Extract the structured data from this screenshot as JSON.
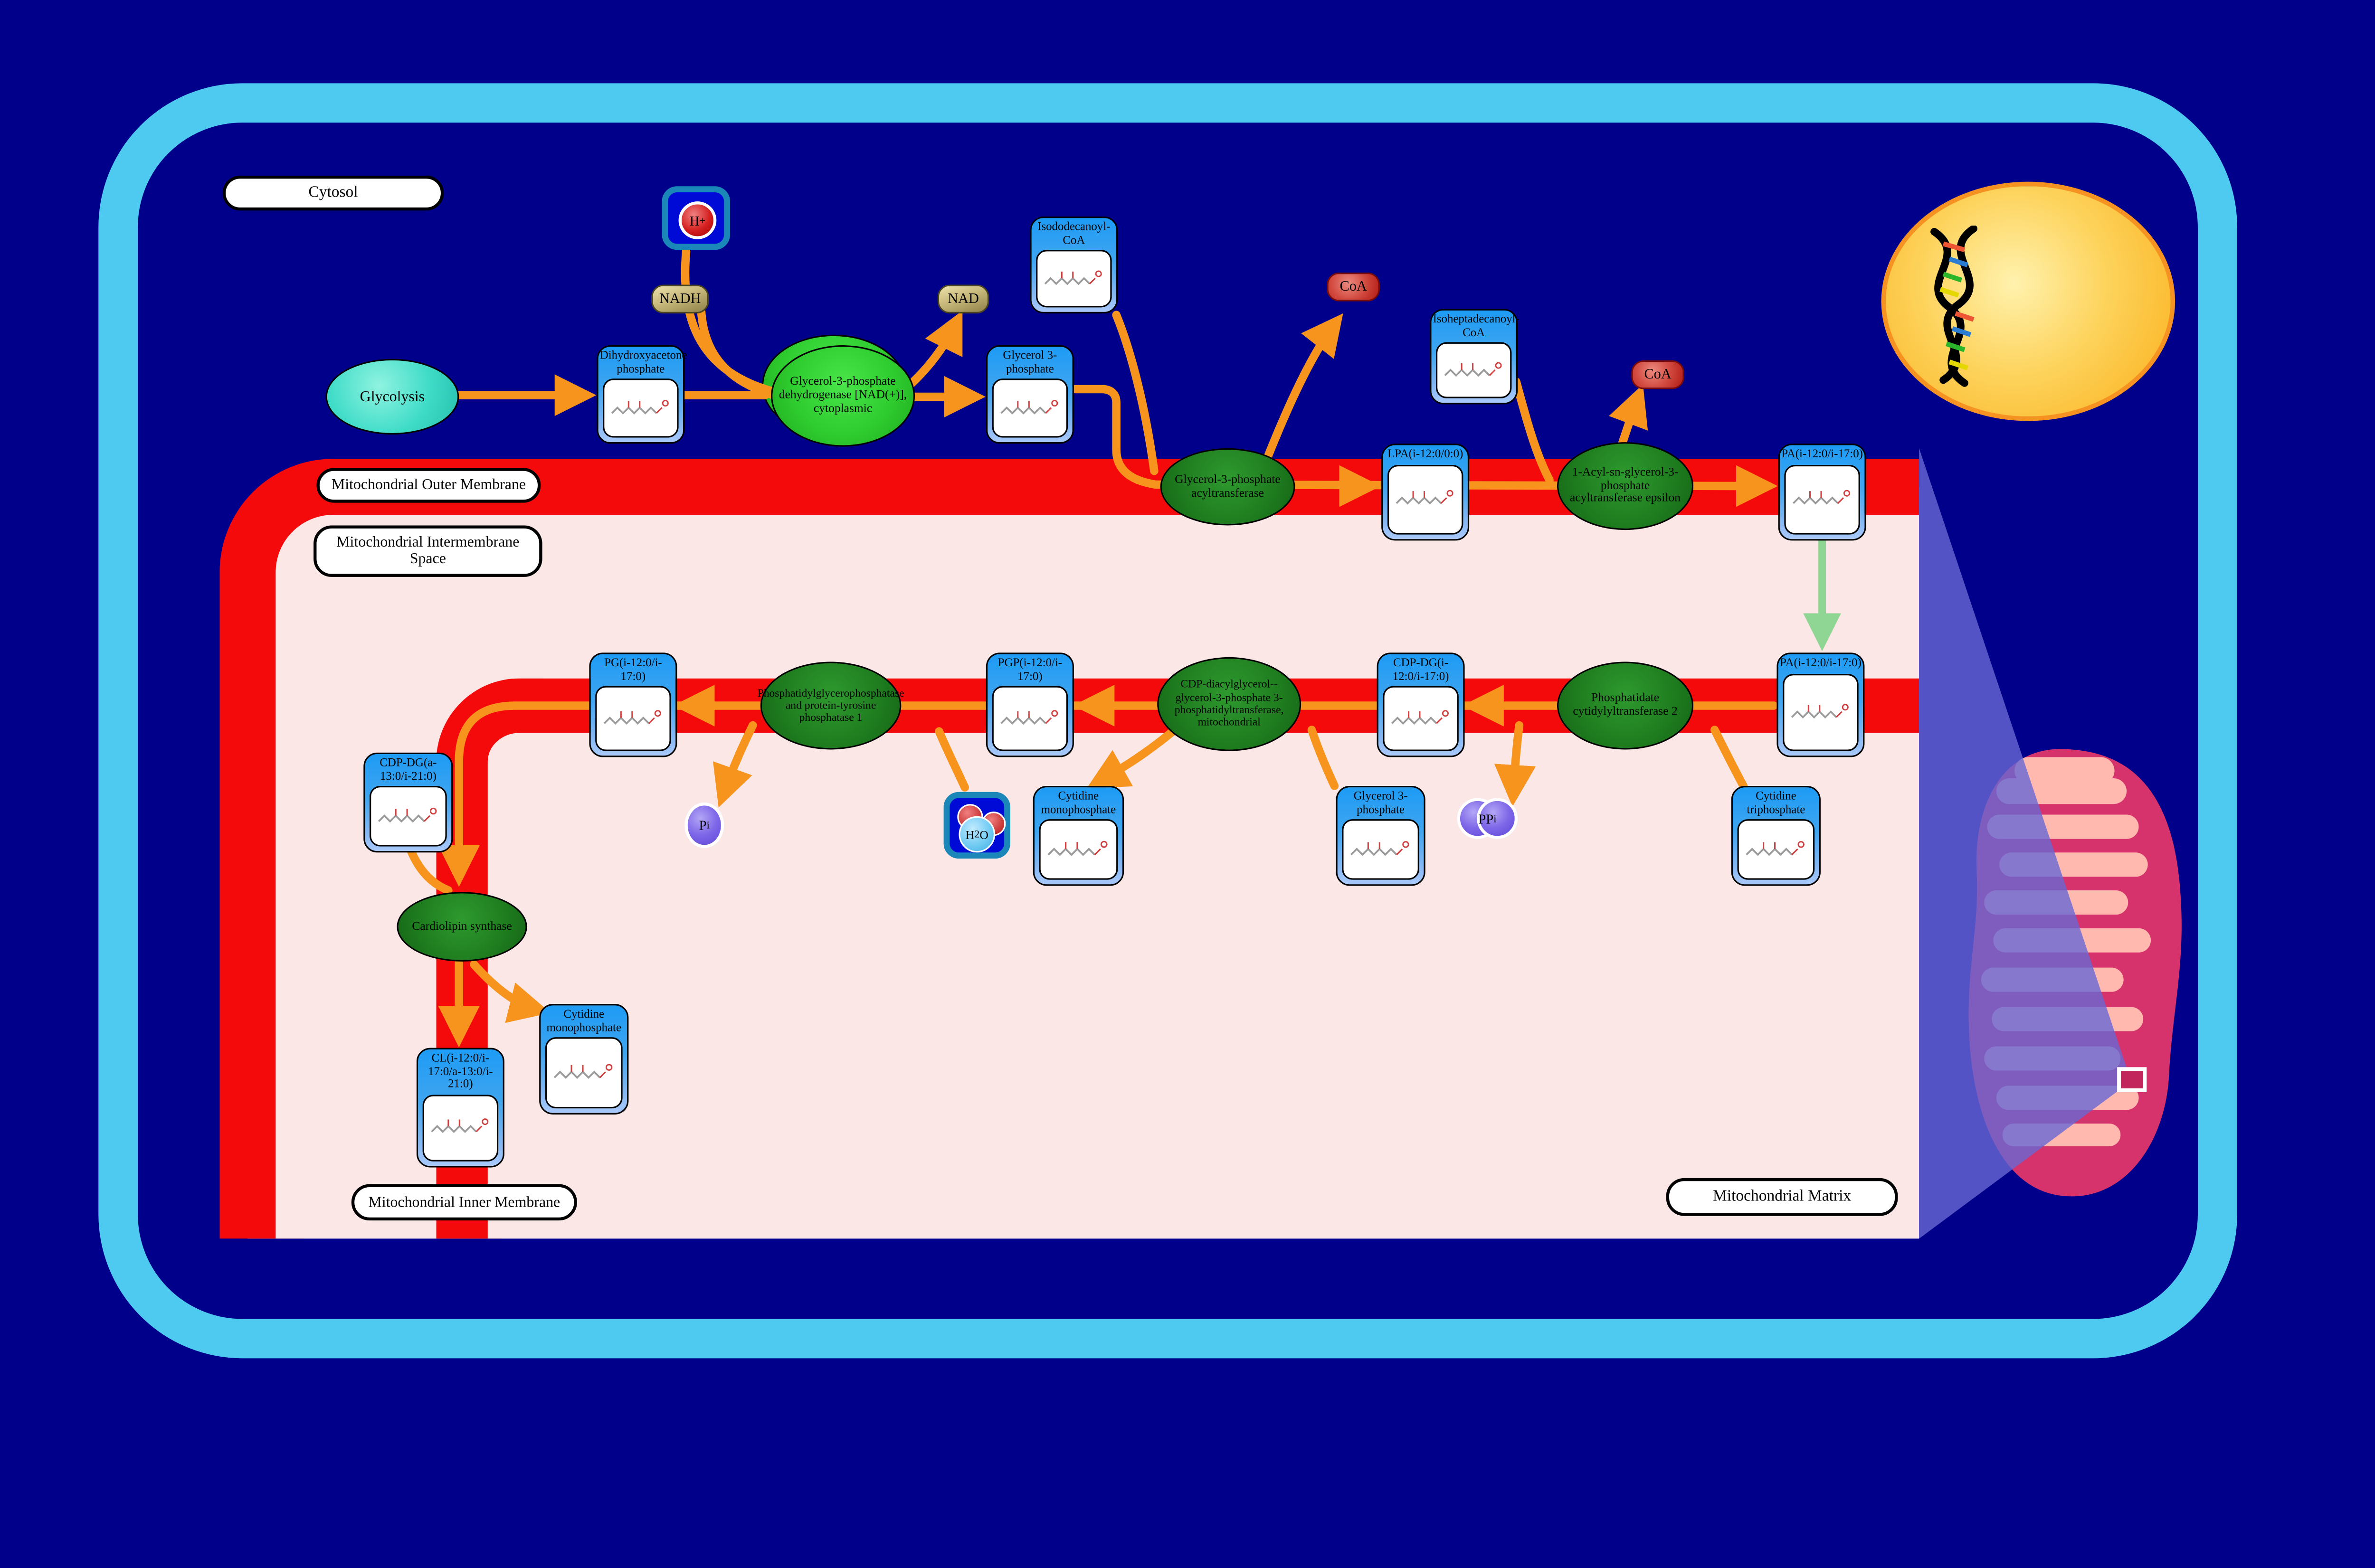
{
  "region_labels": {
    "cytosol": "Cytosol",
    "outer_membrane": "Mitochondrial Outer Membrane",
    "intermembrane_space": "Mitochondrial Intermembrane Space",
    "inner_membrane": "Mitochondrial Inner Membrane",
    "matrix": "Mitochondrial Matrix"
  },
  "pathway": {
    "glycolysis": "Glycolysis"
  },
  "metabolites": {
    "dhap": "Dihydroxyacetone phosphate",
    "g3p_cytosol": "Glycerol 3-phosphate",
    "isododecanoyl_coa": "Isododecanoyl-CoA",
    "isoheptadecanoyl_coa": "Isoheptadecanoyl-CoA",
    "lpa": "LPA(i-12:0/0:0)",
    "pa_outer": "PA(i-12:0/i-17:0)",
    "pa_inner": "PA(i-12:0/i-17:0)",
    "cdp_dg": "CDP-DG(i-12:0/i-17:0)",
    "pgp": "PGP(i-12:0/i-17:0)",
    "pg": "PG(i-12:0/i-17:0)",
    "ctp": "Cytidine triphosphate",
    "g3p_matrix": "Glycerol 3-phosphate",
    "cmp_mid": "Cytidine monophosphate",
    "cdp_dg_acyl": "CDP-DG(a-13:0/i-21:0)",
    "cl": "CL(i-12:0/i-17:0/a-13:0/i-21:0)",
    "cmp_bottom": "Cytidine monophosphate"
  },
  "enzymes": {
    "g3p_dehydrogenase": "Glycerol-3-phosphate dehydrogenase [NAD(+)], cytoplasmic",
    "g3p_acyltransferase": "Glycerol-3-phosphate acyltransferase",
    "agpat_epsilon": "1-Acyl-sn-glycerol-3-phosphate acyltransferase epsilon",
    "pa_cytidylyltransferase": "Phosphatidate cytidylyltransferase 2",
    "cdp_dag_g3p_transferase": "CDP-diacylglycerol--glycerol-3-phosphate 3-phosphatidyltransferase, mitochondrial",
    "pgp_phosphatase": "Phosphatidylglycerophosphatase and protein-tyrosine phosphatase 1",
    "cardiolipin_synthase": "Cardiolipin synthase"
  },
  "small_molecules": {
    "nadh": "NADH",
    "nad": "NAD",
    "coa": "CoA",
    "h_base": "H",
    "h_sup": "+",
    "h2o_h": "H",
    "h2o_sub": "2",
    "h2o_o": "O",
    "pi_base": "P",
    "pi_sub": "i",
    "ppi_base": "PP",
    "ppi_sub": "i"
  },
  "colors": {
    "background_navy": "#00008B",
    "cell_border_blue": "#4EC9F0",
    "membrane_red": "#F40A0A",
    "matrix_pink": "#FCE7E7",
    "node_header_blue": "#1D9BF5",
    "enzyme_green_dark": "#1E7B1E",
    "enzyme_green_bright": "#2ECC2E",
    "arrow_orange": "#F7941D",
    "arrow_green": "#8FD694",
    "nucleus_yellow": "#FBAE17",
    "mitochondrion_crimson": "#D6336C",
    "cristae_salmon": "#FFB9AE",
    "projection_purple": "#6868D4"
  }
}
